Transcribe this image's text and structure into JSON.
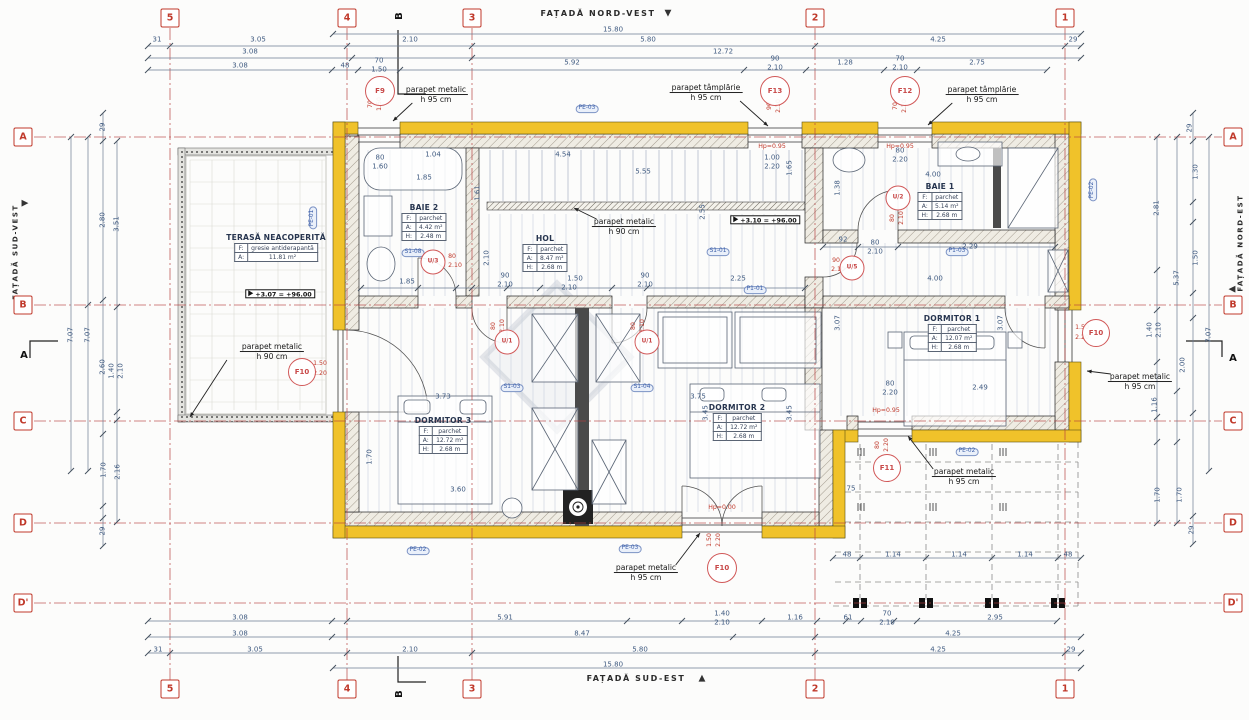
{
  "drawing": {
    "colors": {
      "accent_red": "#c0392b",
      "wall_yellow": "#f0c22a",
      "dim_blue": "#3f5a80",
      "tag_blue": "#3b5ea8"
    },
    "facades": {
      "top": "FAȚADĂ NORD-VEST",
      "bottom": "FAȚADĂ SUD-EST",
      "left": "FAȚADĂ SUD-VEST",
      "right": "FAȚADĂ NORD-EST"
    },
    "grid_cols": [
      {
        "label": "5",
        "x": 170
      },
      {
        "label": "4",
        "x": 347
      },
      {
        "label": "3",
        "x": 472
      },
      {
        "label": "2",
        "x": 815
      },
      {
        "label": "1",
        "x": 1065
      }
    ],
    "grid_rows": [
      {
        "label": "A",
        "y": 137
      },
      {
        "label": "B",
        "y": 305
      },
      {
        "label": "C",
        "y": 421
      },
      {
        "label": "D",
        "y": 523
      },
      {
        "label": "D'",
        "y": 603
      }
    ],
    "sections": [
      {
        "label": "B",
        "x": 400,
        "y": 16,
        "rot": 1
      },
      {
        "label": "B",
        "x": 400,
        "y": 694,
        "rot": 1
      },
      {
        "label": "A",
        "x": 24,
        "y": 356
      },
      {
        "label": "A",
        "x": 1233,
        "y": 359
      }
    ],
    "rooms": [
      {
        "name": "TERASĂ NEACOPERITĂ",
        "x": 276,
        "y": 233,
        "rows": [
          [
            "F:",
            "gresie antiderapantă"
          ],
          [
            "A:",
            "11.81 m²"
          ]
        ]
      },
      {
        "name": "BAIE 2",
        "x": 424,
        "y": 203,
        "rows": [
          [
            "F:",
            "parchet"
          ],
          [
            "A:",
            "4.42 m²"
          ],
          [
            "H:",
            "2.48 m"
          ]
        ]
      },
      {
        "name": "HOL",
        "x": 545,
        "y": 234,
        "rows": [
          [
            "F:",
            "parchet"
          ],
          [
            "A:",
            "8.47 m²"
          ],
          [
            "H:",
            "2.68 m"
          ]
        ]
      },
      {
        "name": "BAIE 1",
        "x": 940,
        "y": 182,
        "rows": [
          [
            "F:",
            "parchet"
          ],
          [
            "A:",
            "5.14 m²"
          ],
          [
            "H:",
            "2.68 m"
          ]
        ]
      },
      {
        "name": "DORMITOR 1",
        "x": 952,
        "y": 314,
        "rows": [
          [
            "F:",
            "parchet"
          ],
          [
            "A:",
            "12.07 m²"
          ],
          [
            "H:",
            "2.68 m"
          ]
        ]
      },
      {
        "name": "DORMITOR 2",
        "x": 737,
        "y": 403,
        "rows": [
          [
            "F:",
            "parchet"
          ],
          [
            "A:",
            "12.72 m²"
          ],
          [
            "H:",
            "2.68 m"
          ]
        ]
      },
      {
        "name": "DORMITOR 3",
        "x": 443,
        "y": 416,
        "rows": [
          [
            "F:",
            "parchet"
          ],
          [
            "A:",
            "12.72 m²"
          ],
          [
            "H:",
            "2.68 m"
          ]
        ]
      }
    ],
    "markers": [
      {
        "id": "F9",
        "x": 380,
        "y": 91,
        "s": 28
      },
      {
        "id": "F13",
        "x": 775,
        "y": 91,
        "s": 28
      },
      {
        "id": "F12",
        "x": 905,
        "y": 91,
        "s": 28
      },
      {
        "id": "F10",
        "x": 302,
        "y": 372,
        "s": 26
      },
      {
        "id": "F10",
        "x": 1096,
        "y": 333,
        "s": 26
      },
      {
        "id": "F10",
        "x": 722,
        "y": 568,
        "s": 28
      },
      {
        "id": "F11",
        "x": 887,
        "y": 468,
        "s": 26
      },
      {
        "id": "U/1",
        "x": 507,
        "y": 342,
        "s": 23
      },
      {
        "id": "U/1",
        "x": 647,
        "y": 342,
        "s": 23
      },
      {
        "id": "U/2",
        "x": 898,
        "y": 198,
        "s": 23
      },
      {
        "id": "U/3",
        "x": 433,
        "y": 262,
        "s": 23
      },
      {
        "id": "U/5",
        "x": 852,
        "y": 268,
        "s": 23
      }
    ],
    "levels": [
      {
        "t": "+3.10 = +96.00",
        "x": 765,
        "y": 220
      },
      {
        "t": "+3.07 = +96.00",
        "x": 280,
        "y": 294
      }
    ],
    "annotations": [
      {
        "lines": [
          "parapet metalic",
          "h 95 cm"
        ],
        "x": 436,
        "y": 95,
        "tx": 393,
        "ty": 121
      },
      {
        "lines": [
          "parapet tâmplărie",
          "h 95 cm"
        ],
        "x": 706,
        "y": 93,
        "tx": 768,
        "ty": 126
      },
      {
        "lines": [
          "parapet tâmplărie",
          "h 95 cm"
        ],
        "x": 982,
        "y": 95,
        "tx": 928,
        "ty": 125
      },
      {
        "lines": [
          "parapet metalic",
          "h 90 cm"
        ],
        "x": 272,
        "y": 352,
        "tx": 190,
        "ty": 417
      },
      {
        "lines": [
          "parapet metalic",
          "h 90 cm"
        ],
        "x": 624,
        "y": 227,
        "tx": 574,
        "ty": 208
      },
      {
        "lines": [
          "parapet metalic",
          "h 95 cm"
        ],
        "x": 1140,
        "y": 382,
        "tx": 1087,
        "ty": 371
      },
      {
        "lines": [
          "parapet metalic",
          "h 95 cm"
        ],
        "x": 964,
        "y": 477,
        "tx": 908,
        "ty": 436
      },
      {
        "lines": [
          "parapet metalic",
          "h 95 cm"
        ],
        "x": 646,
        "y": 573,
        "tx": 700,
        "ty": 533
      }
    ],
    "tags": [
      [
        "PE-03",
        587,
        109
      ],
      [
        "PE-01",
        313,
        218,
        1
      ],
      [
        "PE-02",
        1093,
        190,
        1
      ],
      [
        "PE-02",
        418,
        551
      ],
      [
        "PE-03",
        630,
        549
      ],
      [
        "PE-02",
        967,
        452
      ],
      [
        "S1-08",
        413,
        253
      ],
      [
        "S1-01",
        718,
        252
      ],
      [
        "P1-01",
        755,
        290
      ],
      [
        "P1-03",
        957,
        252
      ],
      [
        "S1-03",
        512,
        388
      ],
      [
        "S1-04",
        642,
        388
      ]
    ],
    "dims": [
      [
        "31",
        157,
        40
      ],
      [
        "3.05",
        258,
        40
      ],
      [
        "2.10",
        410,
        40
      ],
      [
        "15.80",
        613,
        30
      ],
      [
        "5.80",
        648,
        40
      ],
      [
        "4.25",
        938,
        40
      ],
      [
        "29",
        1073,
        40
      ],
      [
        "3.08",
        250,
        52
      ],
      [
        "12.72",
        723,
        52
      ],
      [
        "3.08",
        240,
        66
      ],
      [
        "48",
        345,
        66
      ],
      [
        "70",
        379,
        61
      ],
      [
        "1.50",
        379,
        70
      ],
      [
        "5.92",
        572,
        63
      ],
      [
        "90",
        775,
        59
      ],
      [
        "2.10",
        775,
        68
      ],
      [
        "1.28",
        845,
        63
      ],
      [
        "70",
        900,
        59
      ],
      [
        "2.10",
        900,
        68
      ],
      [
        "2.75",
        977,
        63
      ],
      [
        "80",
        380,
        158
      ],
      [
        "1.60",
        380,
        167
      ],
      [
        "1.04",
        433,
        155
      ],
      [
        "1.85",
        424,
        178
      ],
      [
        "4.54",
        563,
        155
      ],
      [
        "5.55",
        643,
        172
      ],
      [
        "1.00",
        772,
        158
      ],
      [
        "2.20",
        772,
        167
      ],
      [
        "80",
        900,
        151
      ],
      [
        "2.20",
        900,
        160
      ],
      [
        "4.00",
        933,
        175
      ],
      [
        "1.38",
        838,
        188,
        1
      ],
      [
        "1.61",
        478,
        193,
        1
      ],
      [
        "1.65",
        790,
        168,
        1
      ],
      [
        "2.55",
        703,
        212,
        1
      ],
      [
        "2.10",
        487,
        258,
        1
      ],
      [
        "92",
        843,
        240
      ],
      [
        "80",
        875,
        243
      ],
      [
        "2.10",
        875,
        252
      ],
      [
        "2.29",
        970,
        247
      ],
      [
        "4.00",
        935,
        279
      ],
      [
        "1.85",
        407,
        282
      ],
      [
        "90",
        505,
        276
      ],
      [
        "2.10",
        505,
        285
      ],
      [
        "1.50",
        575,
        279
      ],
      [
        "2.10",
        569,
        288
      ],
      [
        "90",
        645,
        276
      ],
      [
        "2.10",
        645,
        285
      ],
      [
        "2.25",
        738,
        279
      ],
      [
        "3.07",
        838,
        323,
        1
      ],
      [
        "3.07",
        1001,
        323,
        1
      ],
      [
        "2.49",
        980,
        388
      ],
      [
        "80",
        890,
        384
      ],
      [
        "2.20",
        890,
        393
      ],
      [
        "3.73",
        443,
        397
      ],
      [
        "3.75",
        698,
        397
      ],
      [
        "3.45",
        706,
        413,
        1
      ],
      [
        "3.45",
        790,
        413,
        1
      ],
      [
        "3.60",
        458,
        490
      ],
      [
        "1.70",
        370,
        457,
        1
      ],
      [
        "75",
        851,
        489
      ],
      [
        "3.08",
        240,
        618
      ],
      [
        "5.91",
        505,
        618
      ],
      [
        "1.40",
        722,
        614
      ],
      [
        "2.10",
        722,
        623
      ],
      [
        "1.16",
        795,
        618
      ],
      [
        "61",
        848,
        618
      ],
      [
        "70",
        887,
        614
      ],
      [
        "2.10",
        887,
        623
      ],
      [
        "2.95",
        995,
        618
      ],
      [
        "3.08",
        240,
        634
      ],
      [
        "8.47",
        582,
        634
      ],
      [
        "4.25",
        953,
        634
      ],
      [
        "31",
        158,
        650
      ],
      [
        "3.05",
        255,
        650
      ],
      [
        "2.10",
        410,
        650
      ],
      [
        "5.80",
        640,
        650
      ],
      [
        "4.25",
        938,
        650
      ],
      [
        "29",
        1071,
        650
      ],
      [
        "15.80",
        613,
        665
      ],
      [
        "48",
        847,
        555
      ],
      [
        "1.14",
        893,
        555
      ],
      [
        "1.14",
        959,
        555
      ],
      [
        "1.14",
        1025,
        555
      ],
      [
        "48",
        1068,
        555
      ],
      [
        "29",
        103,
        127,
        1
      ],
      [
        "2.80",
        103,
        220,
        1
      ],
      [
        "3.51",
        117,
        224,
        1
      ],
      [
        "7.07",
        71,
        335,
        1
      ],
      [
        "7.07",
        88,
        335,
        1
      ],
      [
        "2.60",
        103,
        367,
        1
      ],
      [
        "1.40",
        112,
        371,
        1
      ],
      [
        "2.10",
        121,
        371,
        1
      ],
      [
        "1.70",
        104,
        470,
        1
      ],
      [
        "2.16",
        118,
        472,
        1
      ],
      [
        "29",
        103,
        531,
        1
      ],
      [
        "29",
        1190,
        128,
        1
      ],
      [
        "1.30",
        1196,
        172,
        1
      ],
      [
        "2.81",
        1157,
        208,
        1
      ],
      [
        "1.50",
        1196,
        258,
        1
      ],
      [
        "5.37",
        1177,
        278,
        1
      ],
      [
        "1.40",
        1150,
        330,
        1
      ],
      [
        "2.10",
        1159,
        330,
        1
      ],
      [
        "7.07",
        1209,
        335,
        1
      ],
      [
        "2.00",
        1183,
        365,
        1
      ],
      [
        "1.16",
        1155,
        405,
        1
      ],
      [
        "1.70",
        1158,
        495,
        1
      ],
      [
        "1.70",
        1180,
        495,
        1
      ],
      [
        "29",
        1192,
        530,
        1
      ]
    ],
    "red_dims": [
      [
        "70",
        371,
        104,
        1
      ],
      [
        "1.50",
        380,
        104,
        1
      ],
      [
        "90",
        770,
        106,
        1
      ],
      [
        "2.10",
        779,
        106,
        1
      ],
      [
        "70",
        896,
        106,
        1
      ],
      [
        "2.10",
        905,
        106,
        1
      ],
      [
        "Hp=0.95",
        772,
        147
      ],
      [
        "Hp=0.95",
        900,
        147
      ],
      [
        "80",
        494,
        326,
        1
      ],
      [
        "2.10",
        503,
        326,
        1
      ],
      [
        "80",
        634,
        326,
        1
      ],
      [
        "2.10",
        643,
        326,
        1
      ],
      [
        "80",
        893,
        218,
        1
      ],
      [
        "2.10",
        902,
        218,
        1
      ],
      [
        "80",
        452,
        257
      ],
      [
        "2.10",
        455,
        266
      ],
      [
        "90",
        836,
        261
      ],
      [
        "2.10",
        838,
        270
      ],
      [
        "1.50",
        320,
        364
      ],
      [
        "2.20",
        320,
        374
      ],
      [
        "1.50",
        1082,
        328
      ],
      [
        "2.20",
        1082,
        338
      ],
      [
        "1.50",
        710,
        540,
        1
      ],
      [
        "2.20",
        719,
        540,
        1
      ],
      [
        "Hp=0.00",
        722,
        508
      ],
      [
        "80",
        878,
        445,
        1
      ],
      [
        "2.20",
        887,
        445,
        1
      ],
      [
        "Hp=0.95",
        886,
        411
      ]
    ],
    "dimlines": [
      {
        "o": "h",
        "at": 34,
        "a": 333,
        "b": 1081,
        "t": [
          333,
          1081
        ]
      },
      {
        "o": "h",
        "at": 46,
        "a": 148,
        "b": 1081,
        "t": [
          148,
          170,
          347,
          472,
          815,
          1065,
          1081
        ]
      },
      {
        "o": "h",
        "at": 58,
        "a": 148,
        "b": 1081,
        "t": [
          148,
          352,
          472,
          1081
        ]
      },
      {
        "o": "h",
        "at": 70,
        "a": 148,
        "b": 1047,
        "t": [
          148,
          332,
          358,
          400,
          744,
          806,
          884,
          917,
          1047
        ]
      },
      {
        "o": "h",
        "at": 288,
        "a": 361,
        "b": 805,
        "t": [
          361,
          418,
          456,
          472,
          507,
          540,
          612,
          647,
          805
        ]
      },
      {
        "o": "h",
        "at": 247,
        "a": 823,
        "b": 1055,
        "t": [
          823,
          858,
          898,
          1055
        ]
      },
      {
        "o": "h",
        "at": 621,
        "a": 148,
        "b": 1057,
        "t": [
          148,
          332,
          347,
          627,
          682,
          762,
          817,
          846,
          861,
          894,
          917,
          1057
        ]
      },
      {
        "o": "h",
        "at": 637,
        "a": 148,
        "b": 1081,
        "t": [
          148,
          332,
          733,
          815,
          1081
        ]
      },
      {
        "o": "h",
        "at": 653,
        "a": 148,
        "b": 1081,
        "t": [
          148,
          170,
          347,
          472,
          815,
          1065,
          1081
        ]
      },
      {
        "o": "h",
        "at": 668,
        "a": 333,
        "b": 1081,
        "t": [
          333,
          1081
        ]
      },
      {
        "o": "h",
        "at": 558,
        "a": 833,
        "b": 1081,
        "t": [
          833,
          860,
          926,
          992,
          1058,
          1081
        ]
      },
      {
        "o": "v",
        "at": 103,
        "a": 113,
        "b": 546,
        "t": [
          113,
          141,
          300,
          434,
          506,
          518,
          546
        ]
      },
      {
        "o": "v",
        "at": 117,
        "a": 141,
        "b": 522,
        "t": [
          141,
          307,
          412,
          420,
          522
        ]
      },
      {
        "o": "v",
        "at": 71,
        "a": 137,
        "b": 471,
        "t": [
          137,
          471
        ]
      },
      {
        "o": "v",
        "at": 88,
        "a": 137,
        "b": 471,
        "t": [
          137,
          305,
          471
        ]
      },
      {
        "o": "v",
        "at": 1157,
        "a": 137,
        "b": 523,
        "t": [
          137,
          270,
          310,
          362,
          417,
          442,
          523
        ]
      },
      {
        "o": "v",
        "at": 1177,
        "a": 137,
        "b": 523,
        "t": [
          137,
          391,
          442,
          523
        ]
      },
      {
        "o": "v",
        "at": 1193,
        "a": 113,
        "b": 544,
        "t": [
          113,
          141,
          202,
          222,
          293,
          318,
          413,
          516,
          544
        ]
      },
      {
        "o": "v",
        "at": 1209,
        "a": 137,
        "b": 471,
        "t": [
          137,
          471
        ]
      }
    ]
  }
}
